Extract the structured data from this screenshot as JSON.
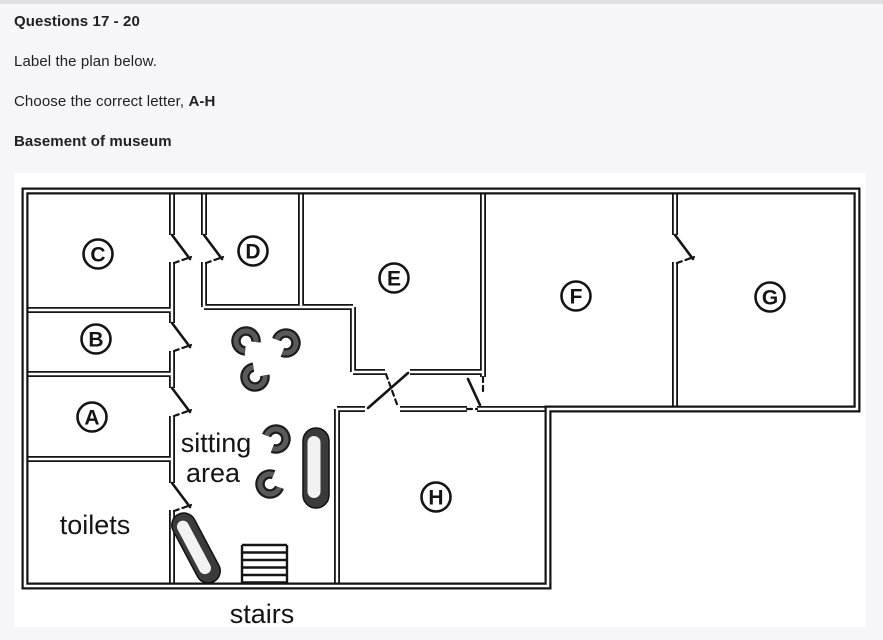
{
  "header": {
    "title": "Questions 17 - 20",
    "line1": "Label the plan below.",
    "line2_prefix": "Choose the correct letter, ",
    "line2_bold": "A-H",
    "subtitle": "Basement of museum"
  },
  "plan": {
    "figure_description": "basement floor plan line drawing",
    "room_labels": [
      "C",
      "D",
      "E",
      "F",
      "G",
      "B",
      "A",
      "H"
    ],
    "area_labels": {
      "sitting_line1": "sitting",
      "sitting_line2": "area",
      "toilets": "toilets",
      "stairs": "stairs"
    },
    "furniture": {
      "chair_count": 5,
      "sofa_count": 2
    }
  },
  "colors": {
    "page_background": "#f6f6f8",
    "top_border": "#dde0e4",
    "card_background": "#ffffff",
    "text": "#202124",
    "plan_ink": "#141414",
    "furniture": "#3b3b3b"
  }
}
